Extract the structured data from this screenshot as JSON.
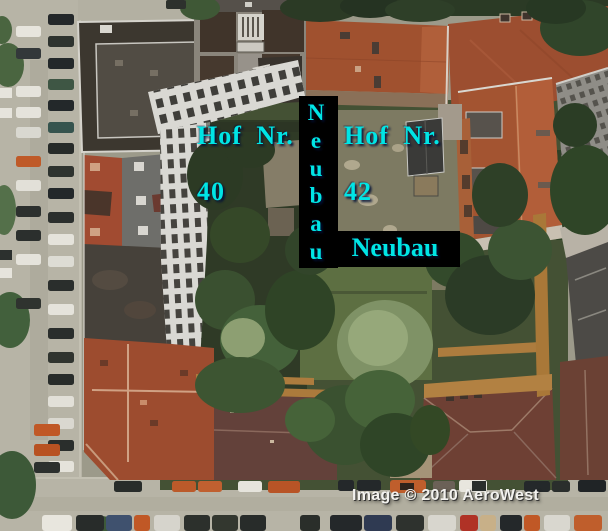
{
  "annotations": {
    "hof_40": {
      "line1": "Hof Nr.",
      "line2": "40"
    },
    "hof_42": {
      "line1": "Hof Nr.",
      "line2": "42"
    },
    "neubau_vertical": {
      "word": "Neubau",
      "letters": [
        "N",
        "e",
        "u",
        "b",
        "a",
        "u"
      ]
    },
    "neubau_horizontal": {
      "label": "Neubau"
    },
    "label_color": "#00e5e5",
    "band_color": "#000000"
  },
  "watermark": {
    "text": "Image © 2010 AeroWest",
    "color": "#f2f1ee"
  }
}
